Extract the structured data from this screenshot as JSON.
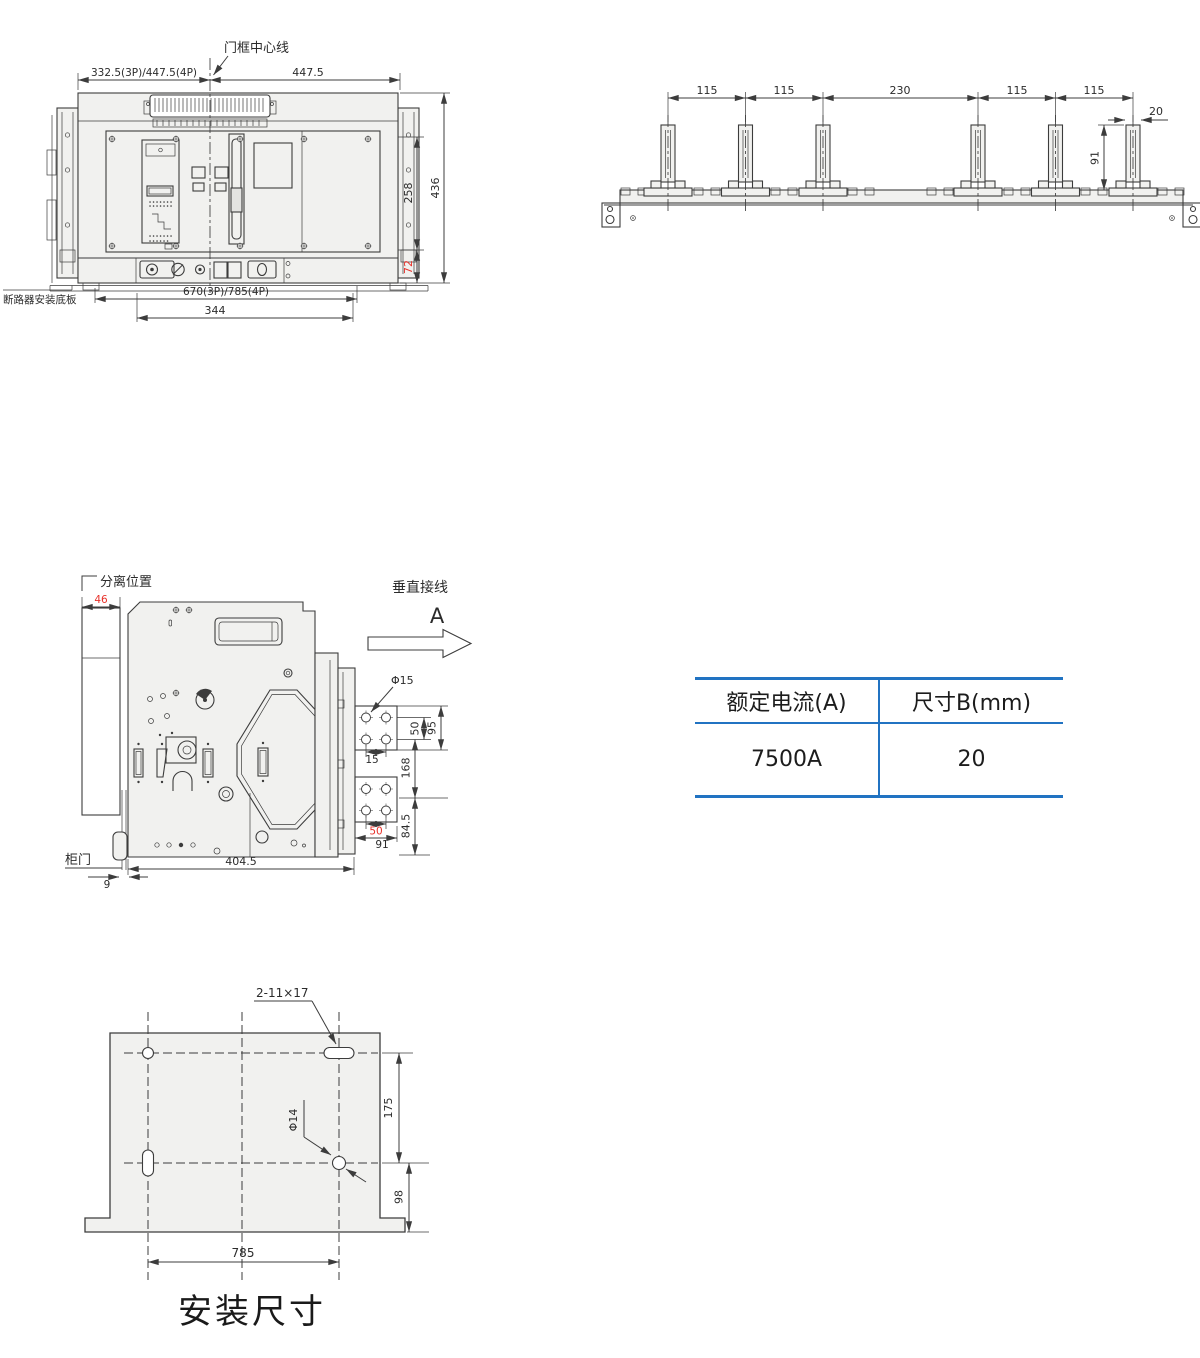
{
  "colors": {
    "line": "#3c3c3c",
    "red": "#e8312a",
    "table_blue": "#2173c2",
    "fill": "#f1f1ef"
  },
  "front_view": {
    "door_center_label": "门框中心线",
    "dim_top_left": "332.5(3P)/447.5(4P)",
    "dim_top_right": "447.5",
    "dim_right_inner": "258",
    "dim_right_outer": "436",
    "dim_right_bottom": "72",
    "dim_bottom_outer": "670(3P)/785(4P)",
    "dim_bottom_inner": "344",
    "base_plate_label": "断路器安装底板"
  },
  "busbar_view": {
    "pitch_dims": [
      "115",
      "115",
      "230",
      "115",
      "115"
    ],
    "dim_bar_width": "20",
    "dim_bar_height": "91"
  },
  "side_view": {
    "separated_label": "分离位置",
    "dim_separated": "46",
    "vertical_wiring_label": "垂直接线",
    "view_label": "A",
    "hole_dia_label": "Φ15",
    "dim_hole_pitch_vertical": "50",
    "dim_pad_height": "95",
    "dim_hole_offset": "15",
    "dim_pad_gap": "168",
    "dim_lower_pad_height": "84.5",
    "dim_hole_pitch_horizontal": "50",
    "dim_pad_width": "91",
    "dim_body_depth": "404.5",
    "cabinet_door_label": "柜门",
    "dim_door_gap": "9"
  },
  "spec_table": {
    "headers": [
      "额定电流(A)",
      "尺寸B(mm)"
    ],
    "row": [
      "7500A",
      "20"
    ]
  },
  "mounting_view": {
    "slot_label": "2-11×17",
    "hole_dia_label": "Φ14",
    "dim_hole_spacing": "175",
    "dim_bottom_offset": "98",
    "dim_width": "785",
    "title": "安装尺寸"
  }
}
